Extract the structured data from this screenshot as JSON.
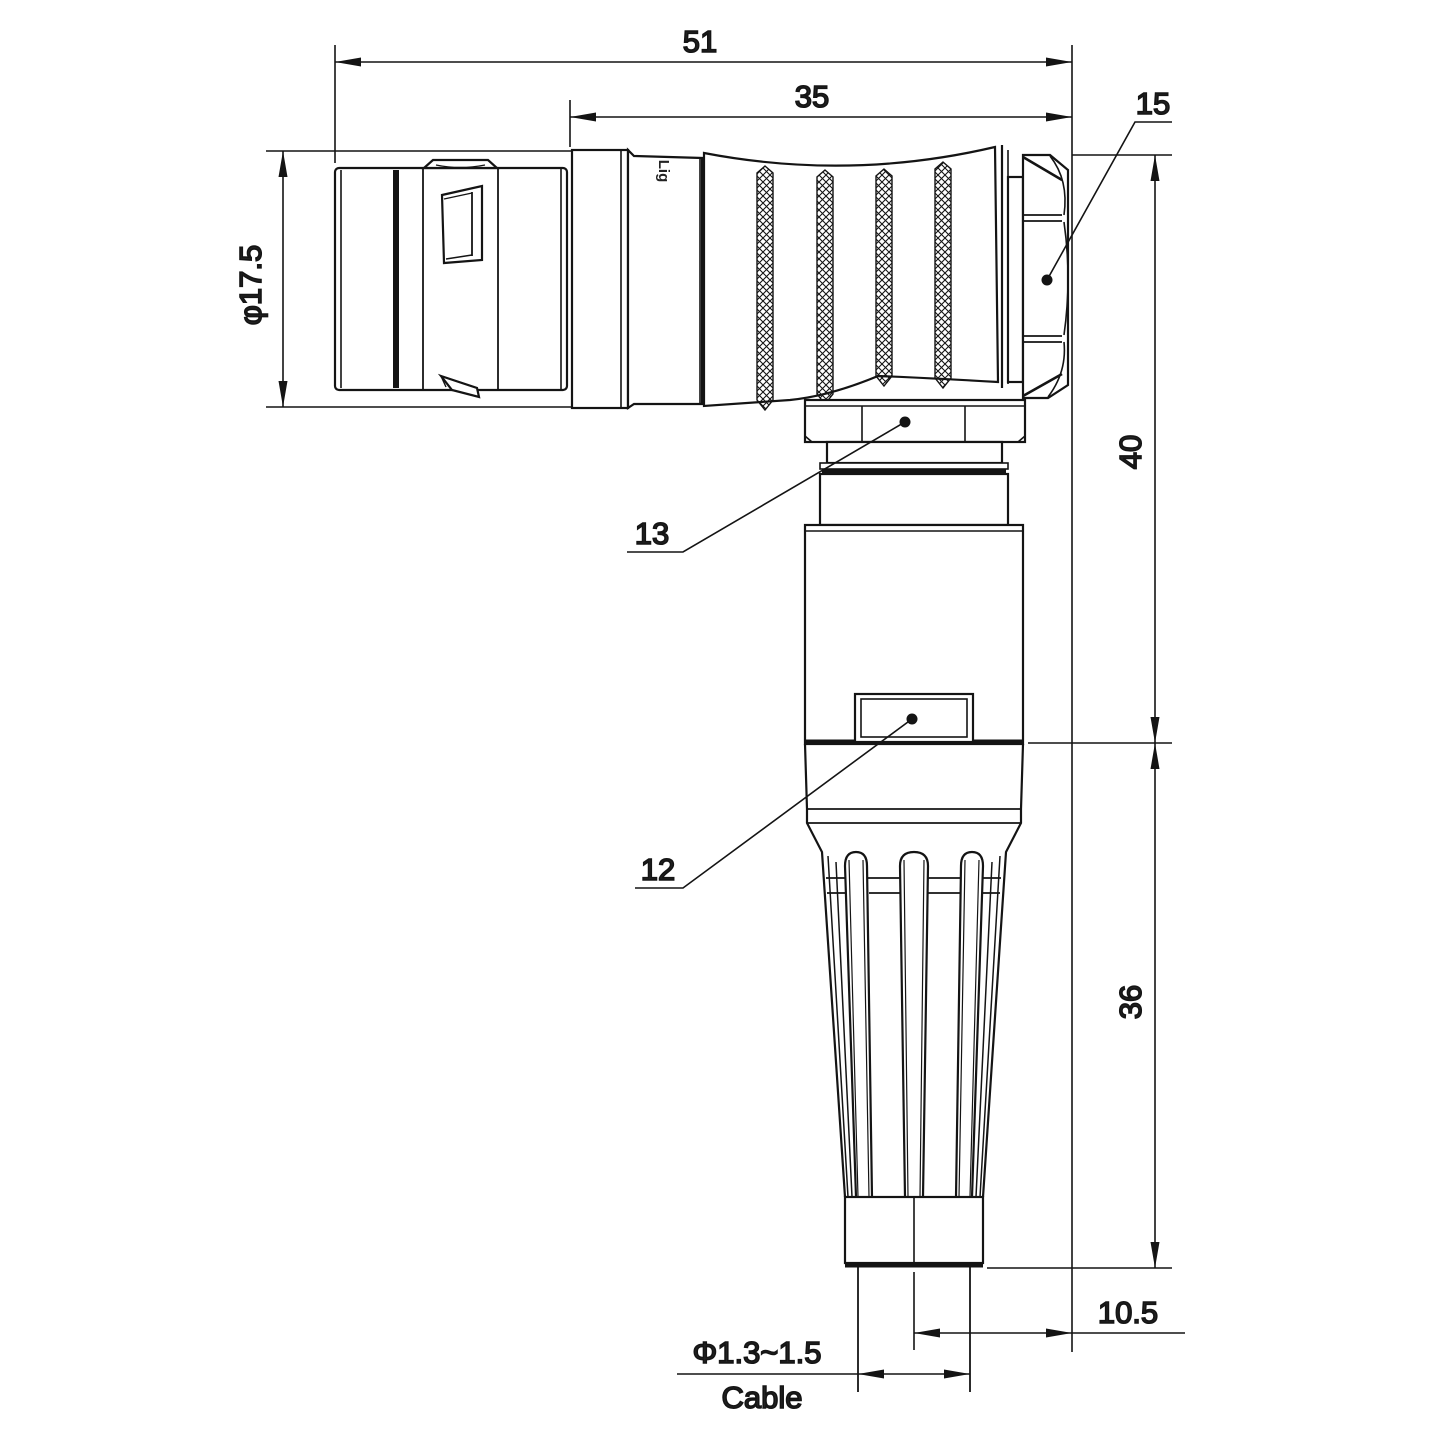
{
  "watermark": "Lightany",
  "engraving": "Lig",
  "dimensions": {
    "overall_length": "51",
    "coupling_length": "35",
    "hex_nut_ref": "15",
    "front_diameter": "φ17.5",
    "upper_height": "40",
    "lower_height": "36",
    "axis_to_back": "10.5",
    "cable_diameter": "Φ1.3~1.5",
    "cable_word": "Cable",
    "ref_13": "13",
    "ref_12": "12"
  },
  "colors": {
    "line": "#141414",
    "dimension_text": "#222222",
    "watermark_pink": "#f2c4c4",
    "background": "#ffffff"
  }
}
